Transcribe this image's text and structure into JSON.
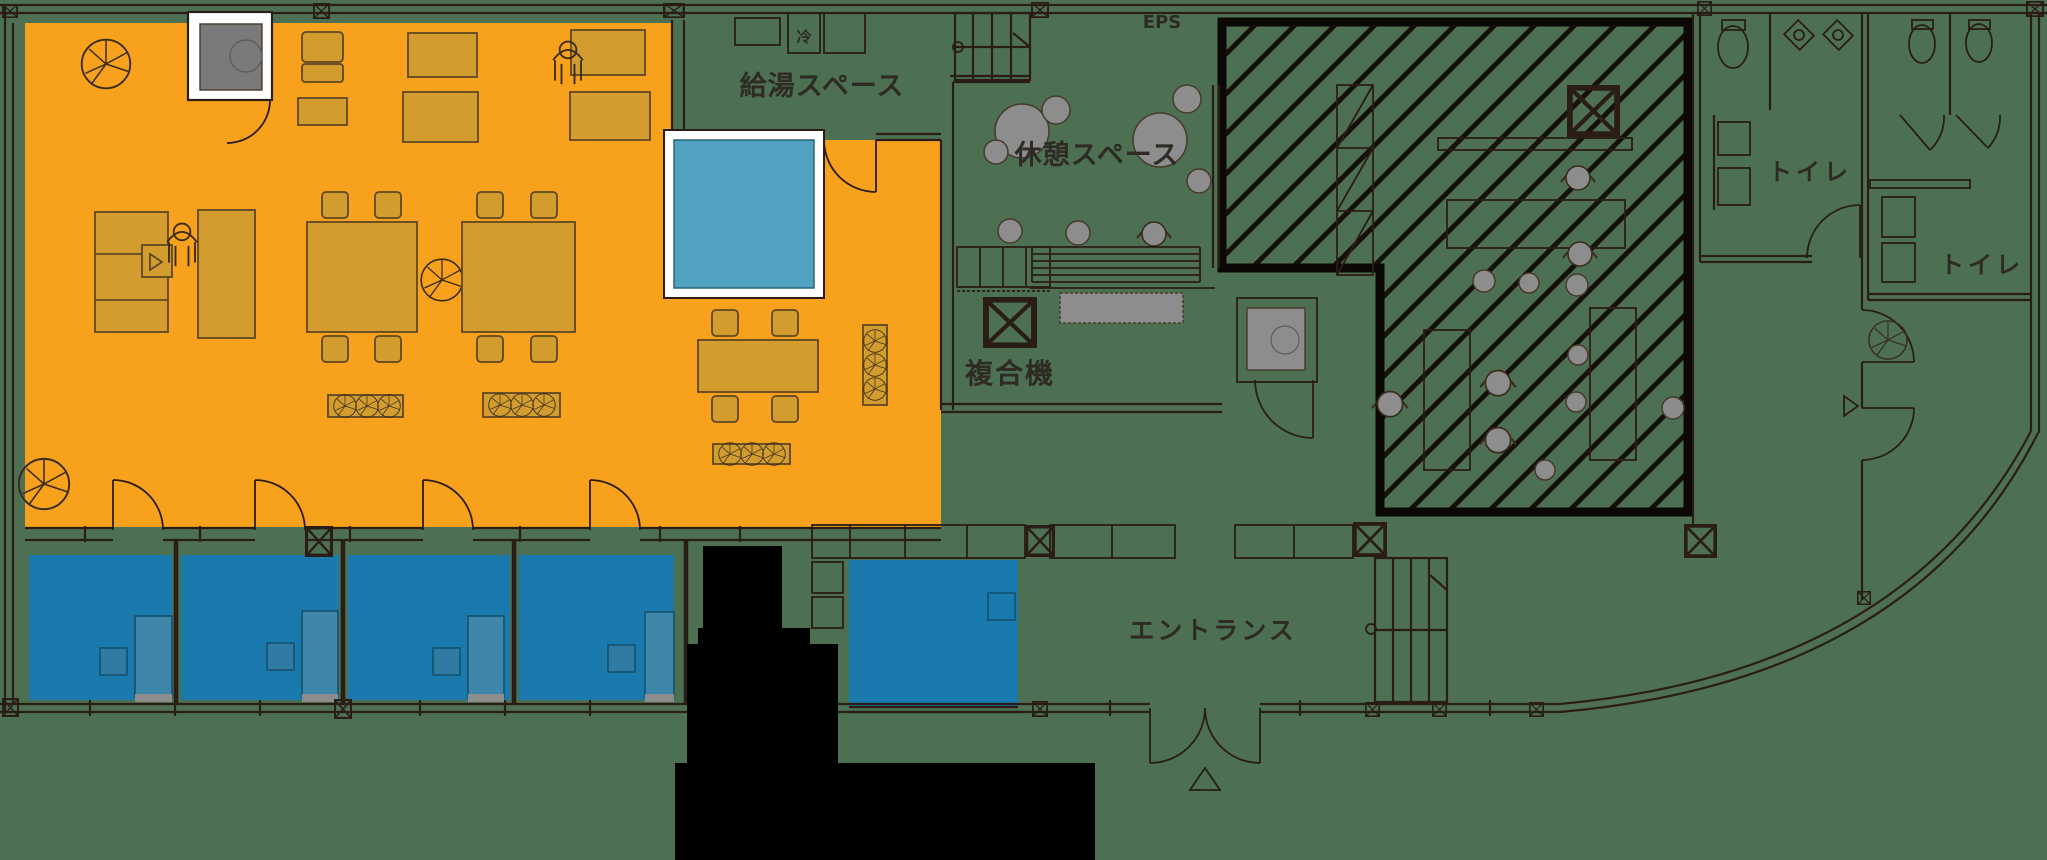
{
  "title": "office-floor-plan",
  "labels": {
    "kitchen": "給湯スペース",
    "rest": "休憩スペース",
    "copier": "複合機",
    "entrance": "エントランス",
    "toilet_left": "トイレ",
    "toilet_right": "トイレ",
    "eps": "EPS",
    "fridge": "冷"
  },
  "colors": {
    "background": "#4d7053",
    "orange": "#f7a11d",
    "furniture": "#d29c2f",
    "furniture_line": "#5e4823",
    "blue_room": "#1a79ad",
    "blue_desk": "#3e87ab",
    "blue_desk_line": "#14506b",
    "teal": "#51a1c0",
    "white": "#ffffff",
    "gray": "#8d8d8d",
    "dark_gray": "#777777",
    "black": "#000000",
    "line": "#2a1d15",
    "hatch": "#16100b",
    "hatch_border": "#0c0805",
    "label": "#2e2a24"
  },
  "zones": [
    {
      "name": "work-lounge-zone",
      "color_key": "orange"
    },
    {
      "name": "meeting-booth-zone",
      "color_key": "blue_room"
    },
    {
      "name": "focus-room-zone",
      "color_key": "teal"
    },
    {
      "name": "hatched-restricted-zone",
      "color_key": "hatch"
    },
    {
      "name": "core-zone",
      "color_key": "black"
    }
  ]
}
